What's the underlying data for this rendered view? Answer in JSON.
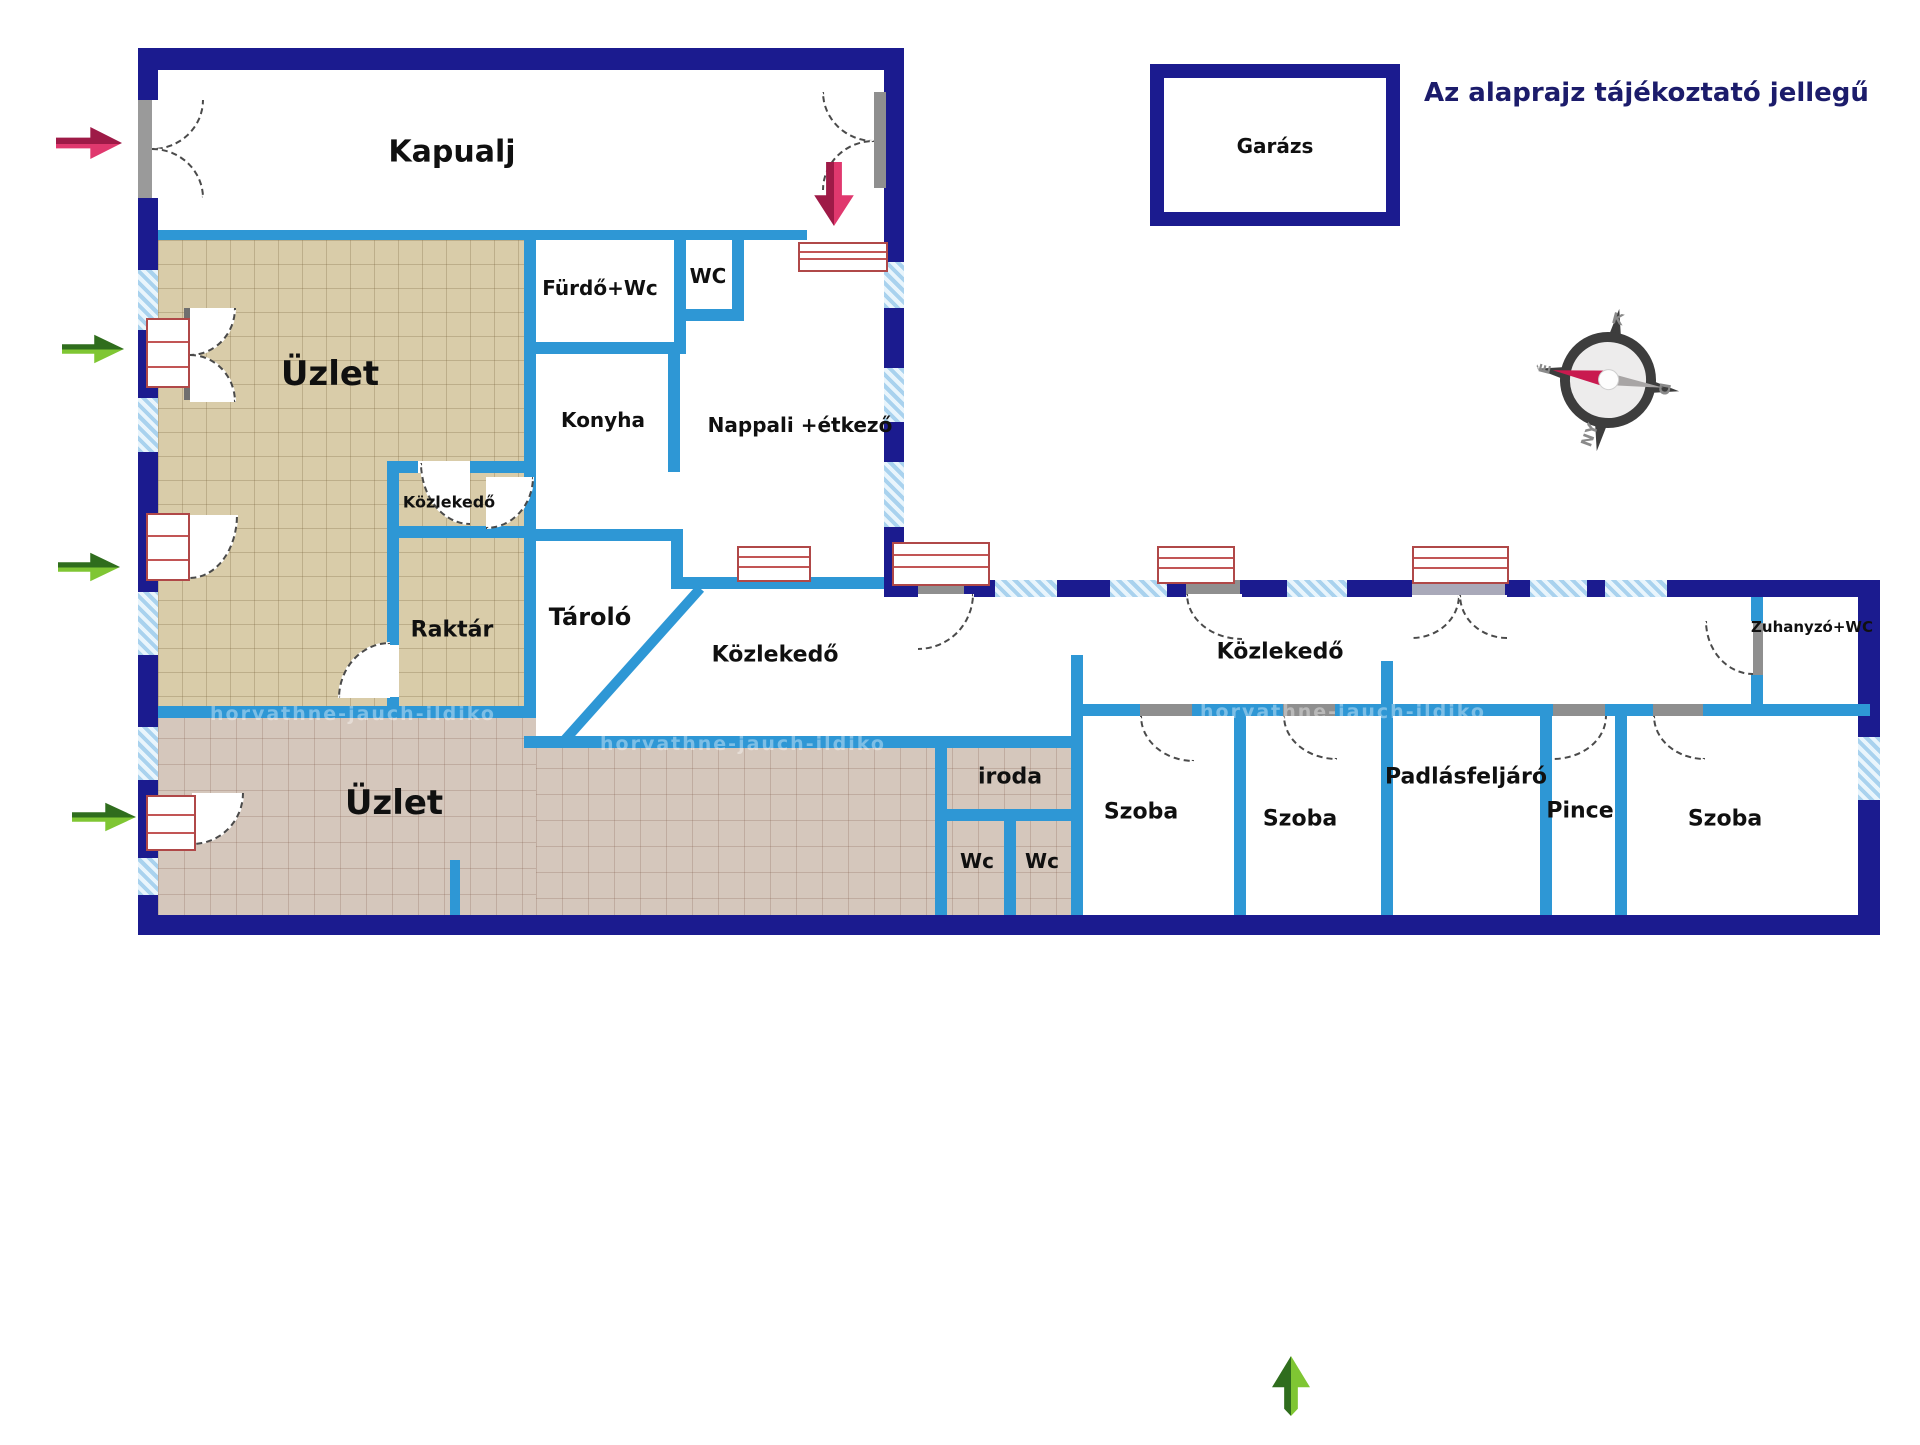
{
  "title": "Az alaprajz tájékoztató jellegű",
  "watermark": "horvathne-jauch-ildiko",
  "rooms": {
    "kapualj": "Kapualj",
    "garazs": "Garázs",
    "uzlet_felso": "Üzlet",
    "furdo_wc": "Fürdő+Wc",
    "wc_kis": "WC",
    "konyha": "Konyha",
    "nappali": "Nappali +étkező",
    "kozlekedo_kis": "Közlekedő",
    "raktar": "Raktár",
    "tarolo": "Tároló",
    "kozlekedo_bal": "Közlekedő",
    "kozlekedo_jobb": "Közlekedő",
    "uzlet_also": "Üzlet",
    "iroda": "iroda",
    "wc1": "Wc",
    "wc2": "Wc",
    "szoba1": "Szoba",
    "szoba2": "Szoba",
    "padlasfeljaro": "Padlásfeljáró",
    "pince": "Pince",
    "szoba3": "Szoba",
    "zuhanyzo": "Zuhanyzó+WC"
  },
  "compass": {
    "north": "É",
    "east": "K",
    "south": "D",
    "west": "NY"
  },
  "colors": {
    "outer_wall": "#1b1b8f",
    "inner_wall": "#2e97d5",
    "window_hatch": "#a9d2ee",
    "floor_shop_upper": "#d9cca9",
    "floor_shop_lower": "#d5c7bc",
    "red_frame": "#b04848",
    "arrow_green_dark": "#2f6d1d",
    "arrow_green_light": "#7fc633",
    "arrow_crimson": "#c91a4f",
    "title_color": "#1c1c6b"
  }
}
